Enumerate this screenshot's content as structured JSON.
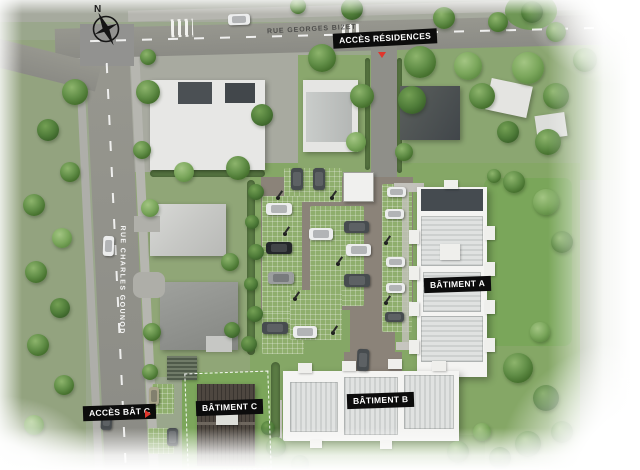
{
  "compass": {
    "north_label": "N"
  },
  "streets": {
    "rue_georges_bizet": "RUE GEORGES BIZET",
    "rue_charles_gounod": "RUE CHARLES GOUNOD"
  },
  "annotations": {
    "acces_residences": "ACCÈS RÉSIDENCES",
    "acces_bat_c": "ACCÈS BÂT C"
  },
  "buildings": {
    "batiment_a": "BÂTIMENT A",
    "batiment_b": "BÂTIMENT B",
    "batiment_c": "BÂTIMENT C"
  },
  "colors": {
    "annotation_bg": "#0c0c0c",
    "annotation_text": "#ffffff",
    "direction_arrow": "#e0352c",
    "street_text_on_road": "#4d4d4b",
    "street_text_white": "#ffffff"
  }
}
